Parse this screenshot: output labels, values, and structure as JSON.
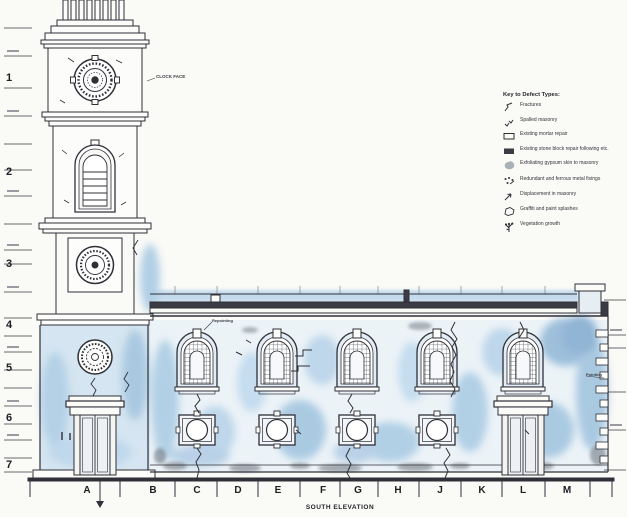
{
  "drawing": {
    "title": "SOUTH ELEVATION",
    "labels": {
      "clock_face": "CLOCK FACE",
      "repointing": "Repointing",
      "pointing": "Pointing"
    },
    "grid_letters": [
      {
        "label": "A",
        "x": 87,
        "y": 485
      },
      {
        "label": "B",
        "x": 153,
        "y": 485
      },
      {
        "label": "C",
        "x": 197,
        "y": 485
      },
      {
        "label": "D",
        "x": 238,
        "y": 485
      },
      {
        "label": "E",
        "x": 278,
        "y": 485
      },
      {
        "label": "F",
        "x": 323,
        "y": 485
      },
      {
        "label": "G",
        "x": 358,
        "y": 485
      },
      {
        "label": "H",
        "x": 398,
        "y": 485
      },
      {
        "label": "J",
        "x": 440,
        "y": 485
      },
      {
        "label": "K",
        "x": 482,
        "y": 485
      },
      {
        "label": "L",
        "x": 523,
        "y": 485
      },
      {
        "label": "M",
        "x": 567,
        "y": 485
      }
    ],
    "row_numbers": [
      {
        "label": "1",
        "x": 6,
        "y": 78
      },
      {
        "label": "2",
        "x": 6,
        "y": 172
      },
      {
        "label": "3",
        "x": 6,
        "y": 264
      },
      {
        "label": "4",
        "x": 6,
        "y": 325
      },
      {
        "label": "5",
        "x": 6,
        "y": 368
      },
      {
        "label": "6",
        "x": 6,
        "y": 418
      },
      {
        "label": "7",
        "x": 6,
        "y": 465
      }
    ]
  },
  "legend": {
    "title": "Key to Defect Types:",
    "items": [
      {
        "symbol": "fracture-symbol",
        "label": "Fractures"
      },
      {
        "symbol": "spalled-masonry-symbol",
        "label": "Spalled masonry"
      },
      {
        "symbol": "mortar-repair-symbol",
        "label": "Existing mortar repair"
      },
      {
        "symbol": "stone-repair-symbol",
        "label": "Existing stone block repair following etc."
      },
      {
        "symbol": "gypsum-symbol",
        "label": "Exfoliating gypsum skin to masonry"
      },
      {
        "symbol": "metal-fixings-symbol",
        "label": "Redundant and ferrous metal fixings"
      },
      {
        "symbol": "displacement-symbol",
        "label": "Displacement in masonry"
      },
      {
        "symbol": "graffiti-symbol",
        "label": "Graffiti and paint splashes"
      },
      {
        "symbol": "vegetation-symbol",
        "label": "Vegetation growth"
      }
    ]
  },
  "colors": {
    "wash_blue": "#aecbe5",
    "dense_blue": "#7fa9cf",
    "line_dark": "#2f3038",
    "paper": "#fafaf7"
  }
}
